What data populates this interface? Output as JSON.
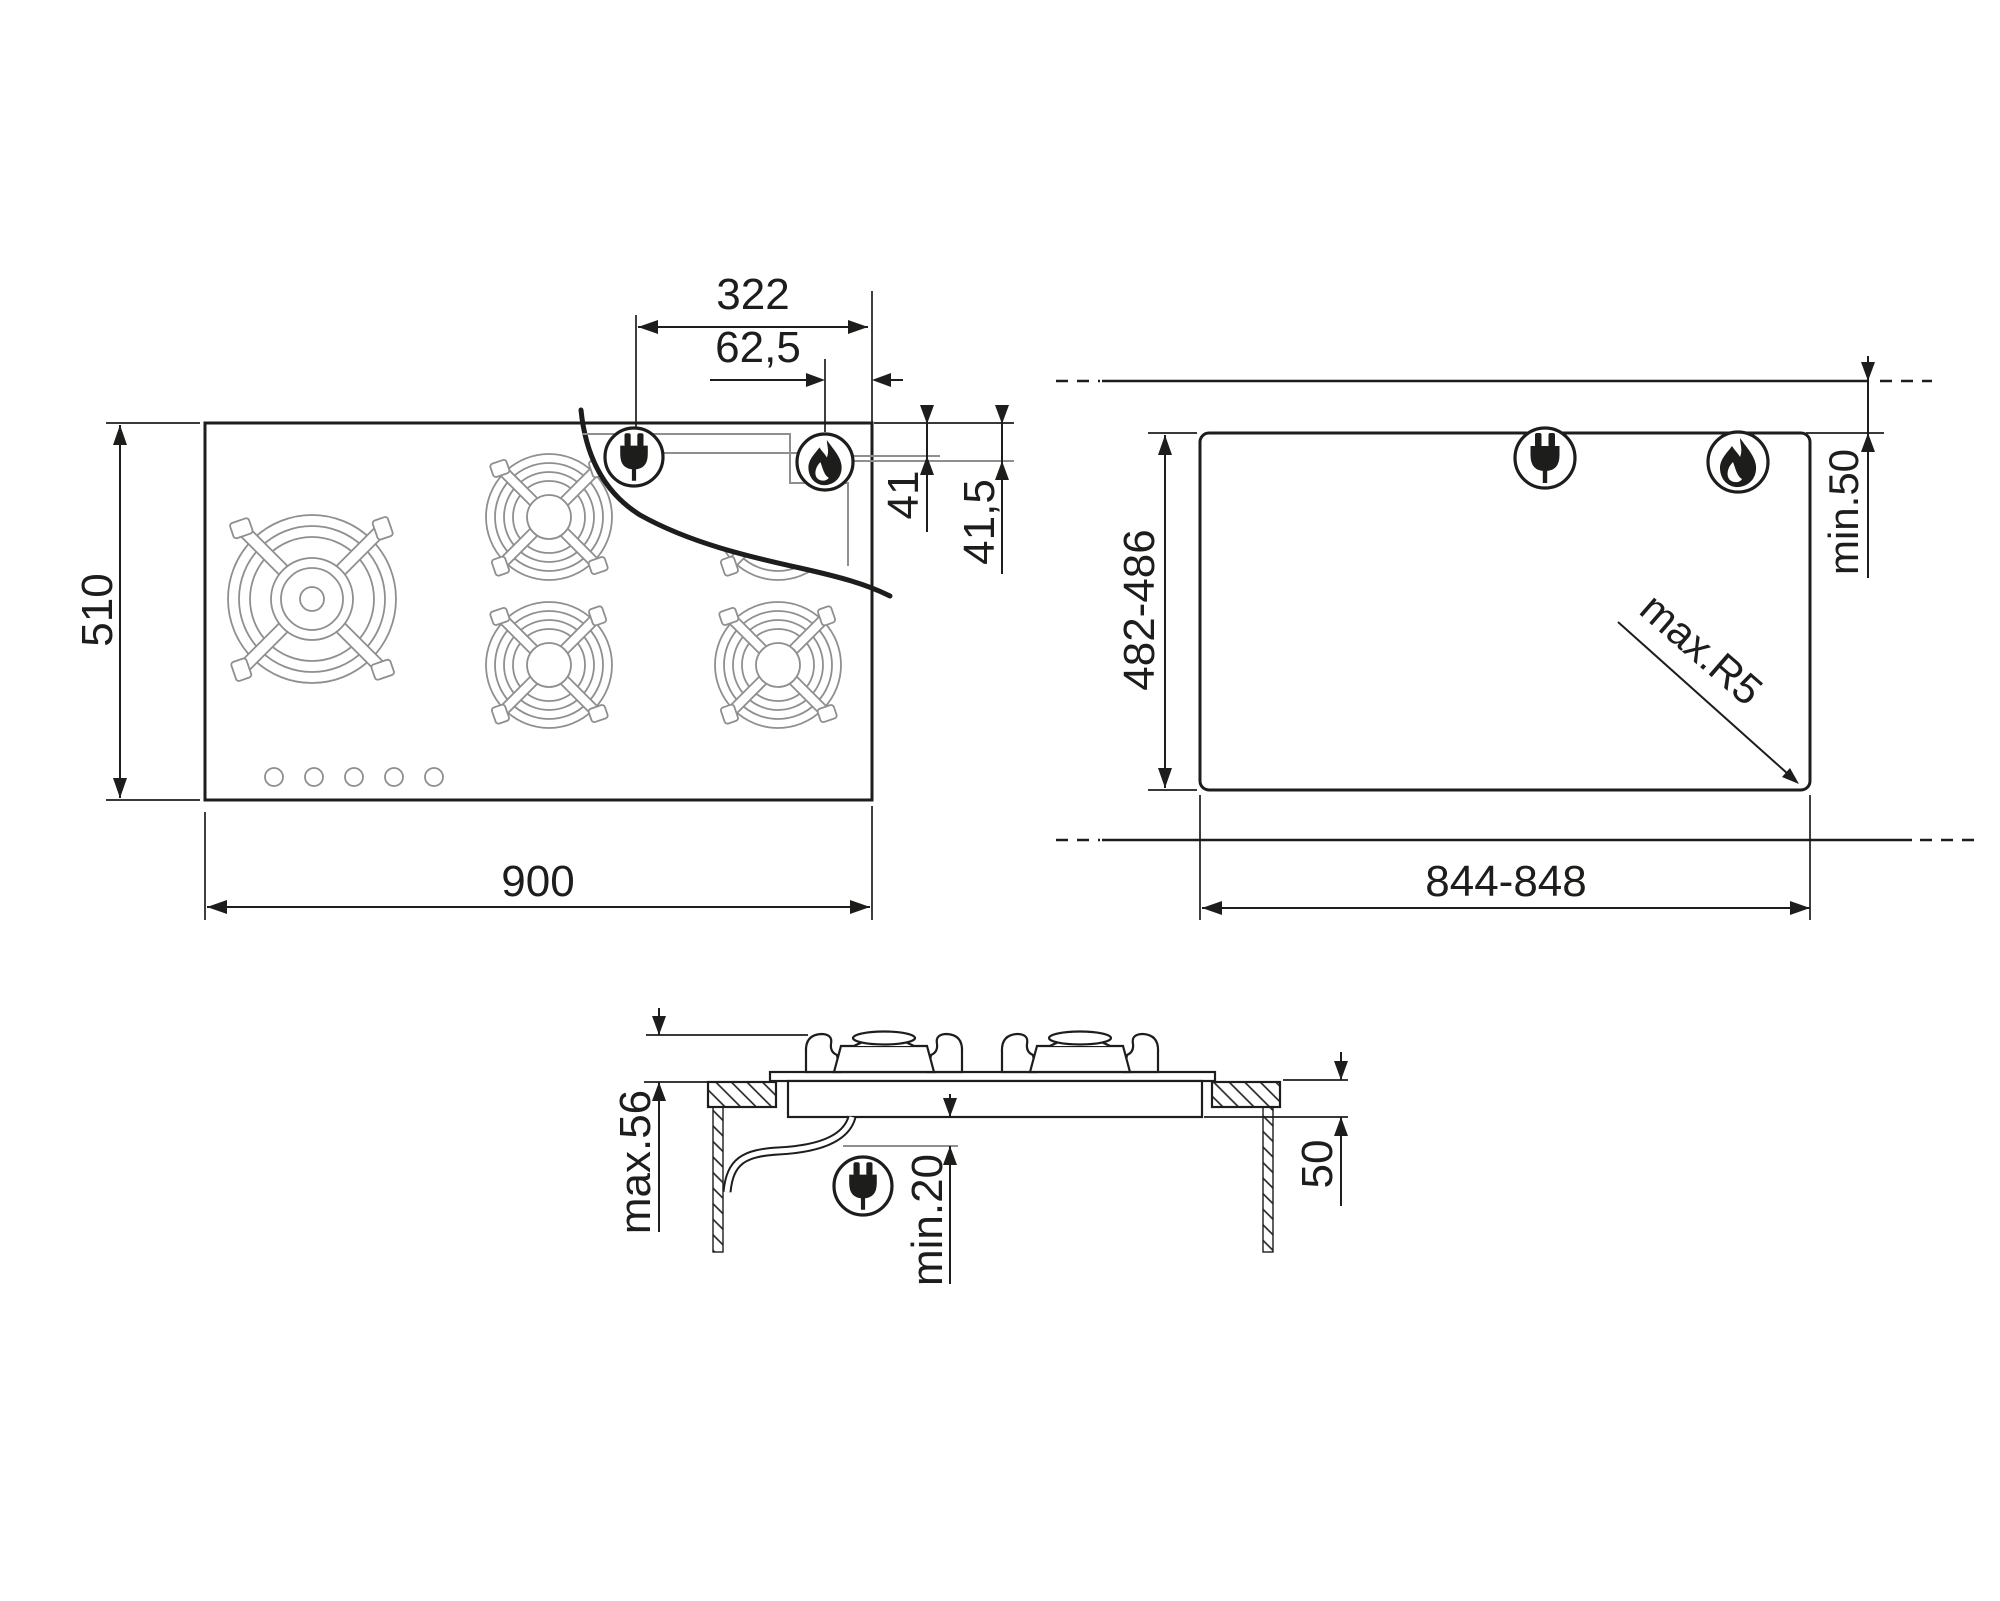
{
  "drawing": {
    "title": "gas-hob-installation-drawing",
    "background_color": "#ffffff",
    "line_color": "#1d1d1b",
    "secondary_line_color": "#8f8f8f",
    "plan_view": {
      "description": "hob-top-view",
      "depth_mm": "510",
      "width_mm": "900",
      "electric_connection_offset_mm": "322",
      "gas_connection_offset_mm": "62,5",
      "gas_connection_inset_mm": "41",
      "gas_connection_inset_total_mm": "41,5",
      "burner_count": 5,
      "knob_count": 5,
      "icons": [
        "power-plug-icon",
        "gas-flame-icon"
      ]
    },
    "cutout_view": {
      "description": "worktop-cutout-view",
      "depth_mm": "482-486",
      "width_mm": "844-848",
      "rear_clearance_mm": "min.50",
      "corner_radius_mm": "max.R5",
      "icons": [
        "power-plug-icon",
        "gas-flame-icon"
      ]
    },
    "section_view": {
      "description": "side-section-view",
      "height_above_worktop_mm": "max.56",
      "clearance_below_mm": "min.20",
      "depth_below_worktop_mm": "50",
      "icons": [
        "power-plug-icon"
      ]
    }
  }
}
